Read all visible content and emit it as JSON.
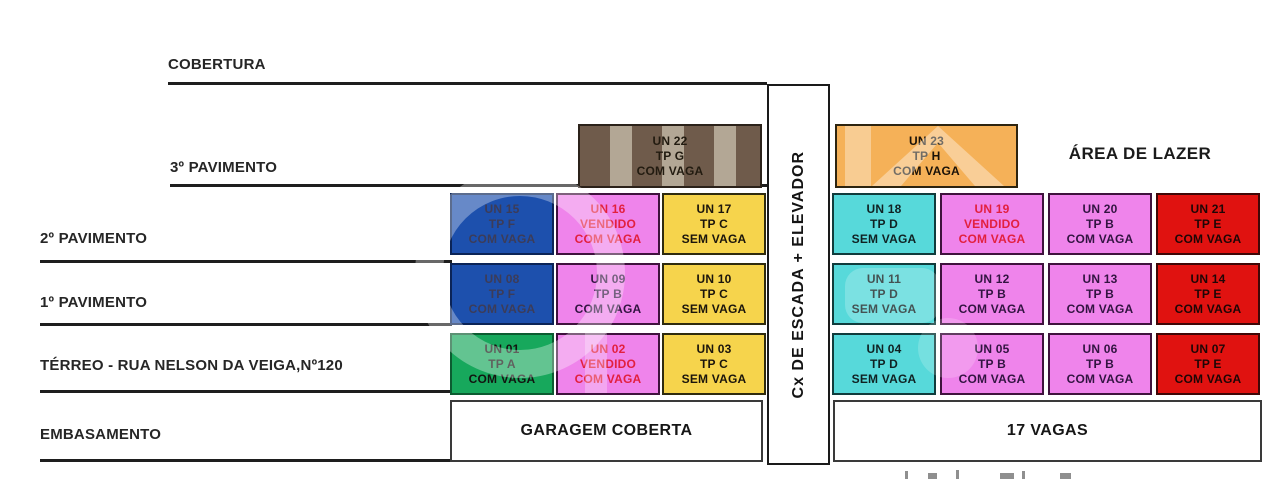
{
  "diagram": {
    "floors": [
      {
        "label": "COBERTURA"
      },
      {
        "label": "3º PAVIMENTO"
      },
      {
        "label": "2º PAVIMENTO"
      },
      {
        "label": "1º PAVIMENTO"
      },
      {
        "label": "TÉRREO - RUA NELSON DA VEIGA,Nº120"
      },
      {
        "label": "EMBASAMENTO"
      }
    ],
    "core_label": "Cx DE ESCADA + ELEVADOR",
    "leisure_label": "ÁREA DE LAZER",
    "garage_label": "GARAGEM COBERTA",
    "parking_label": "17 VAGAS",
    "status_colors": {
      "available_green": "#17A85C",
      "pink": "#EF84EB",
      "yellow": "#F6D44C",
      "cyan": "#57D9DA",
      "red": "#E01210",
      "blue": "#1D50AD",
      "orange": "#F5B158",
      "brown": "#6F5B4B",
      "vendido_text": "#E2203E"
    },
    "units": [
      {
        "un": "UN 01",
        "line2": "TP A",
        "line3": "COM VAGA",
        "fill": "#17A85C",
        "border": "#0C5C31",
        "text_color": "#121410"
      },
      {
        "un": "UN 02",
        "line2": "VENDIDO",
        "line3": "COM VAGA",
        "fill": "#EF84EB",
        "border": "#3F123D",
        "text_color": "#E2203E"
      },
      {
        "un": "UN 03",
        "line2": "TP C",
        "line3": "SEM VAGA",
        "fill": "#F6D44C",
        "border": "#2F2B0E",
        "text_color": "#1B150C"
      },
      {
        "un": "UN 04",
        "line2": "TP D",
        "line3": "SEM VAGA",
        "fill": "#57D9DA",
        "border": "#103C3C",
        "text_color": "#102223"
      },
      {
        "un": "UN 05",
        "line2": "TP B",
        "line3": "COM VAGA",
        "fill": "#EF84EB",
        "border": "#3F123D",
        "text_color": "#321441"
      },
      {
        "un": "UN 06",
        "line2": "TP B",
        "line3": "COM VAGA",
        "fill": "#EF84EB",
        "border": "#3F123D",
        "text_color": "#321441"
      },
      {
        "un": "UN 07",
        "line2": "TP E",
        "line3": "COM VAGA",
        "fill": "#E01210",
        "border": "#3F0707",
        "text_color": "#1E0606"
      },
      {
        "un": "UN 08",
        "line2": "TP F",
        "line3": "COM VAGA",
        "fill": "#1D50AD",
        "border": "#0B2457",
        "text_color": "#3C3C58"
      },
      {
        "un": "UN 09",
        "line2": "TP B",
        "line3": "COM VAGA",
        "fill": "#EF84EB",
        "border": "#3F123D",
        "text_color": "#321441"
      },
      {
        "un": "UN 10",
        "line2": "TP C",
        "line3": "SEM VAGA",
        "fill": "#F6D44C",
        "border": "#2F2B0E",
        "text_color": "#1B150C"
      },
      {
        "un": "UN 11",
        "line2": "TP D",
        "line3": "SEM VAGA",
        "fill": "#57D9DA",
        "border": "#103C3C",
        "text_color": "#102223"
      },
      {
        "un": "UN 12",
        "line2": "TP B",
        "line3": "COM VAGA",
        "fill": "#EF84EB",
        "border": "#3F123D",
        "text_color": "#321441"
      },
      {
        "un": "UN 13",
        "line2": "TP B",
        "line3": "COM VAGA",
        "fill": "#EF84EB",
        "border": "#3F123D",
        "text_color": "#321441"
      },
      {
        "un": "UN 14",
        "line2": "TP E",
        "line3": "COM VAGA",
        "fill": "#E01210",
        "border": "#3F0707",
        "text_color": "#1E0606"
      },
      {
        "un": "UN 15",
        "line2": "TP F",
        "line3": "COM VAGA",
        "fill": "#1D50AD",
        "border": "#0B2457",
        "text_color": "#3C3C58"
      },
      {
        "un": "UN 16",
        "line2": "VENDIDO",
        "line3": "COM VAGA",
        "fill": "#EF84EB",
        "border": "#3F123D",
        "text_color": "#E2203E"
      },
      {
        "un": "UN 17",
        "line2": "TP C",
        "line3": "SEM VAGA",
        "fill": "#F6D44C",
        "border": "#2F2B0E",
        "text_color": "#1B150C"
      },
      {
        "un": "UN 18",
        "line2": "TP D",
        "line3": "SEM VAGA",
        "fill": "#57D9DA",
        "border": "#103C3C",
        "text_color": "#102223"
      },
      {
        "un": "UN 19",
        "line2": "VENDIDO",
        "line3": "COM VAGA",
        "fill": "#EF84EB",
        "border": "#3F123D",
        "text_color": "#E2203E"
      },
      {
        "un": "UN 20",
        "line2": "TP B",
        "line3": "COM VAGA",
        "fill": "#EF84EB",
        "border": "#3F123D",
        "text_color": "#321441"
      },
      {
        "un": "UN 21",
        "line2": "TP E",
        "line3": "COM VAGA",
        "fill": "#E01210",
        "border": "#3F0707",
        "text_color": "#1E0606"
      },
      {
        "un": "UN 22",
        "line2": "TP G",
        "line3": "COM VAGA",
        "fill": "#6F5B4B",
        "stripe": "#B3A795",
        "border": "#2B221A",
        "text_color": "#221B10"
      },
      {
        "un": "UN 23",
        "line2": "TP H",
        "line3": "COM VAGA",
        "fill": "#F5B158",
        "border": "#2D2410",
        "text_color": "#1A1208"
      }
    ]
  }
}
